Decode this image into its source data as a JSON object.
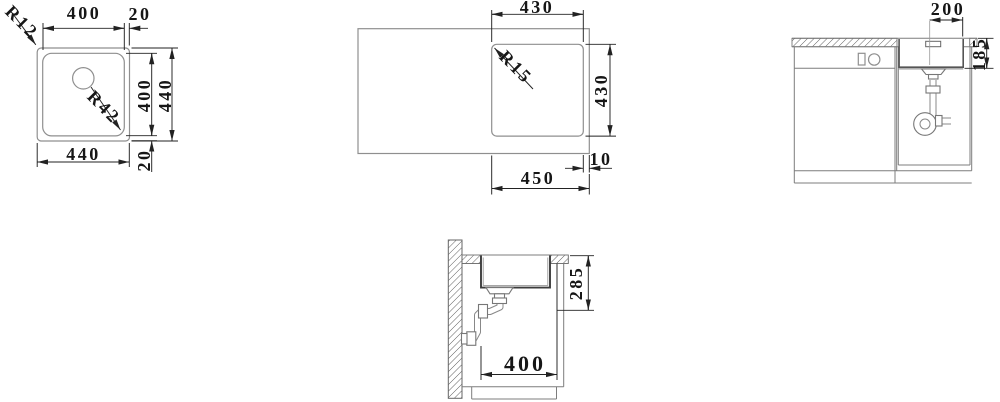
{
  "drawing_title": "sink-installation-drawing",
  "views": {
    "sink_top": {
      "dims": {
        "top_width": "400",
        "top_rim": "20",
        "inner_height": "400",
        "outer_height": "440",
        "bottom_width": "440",
        "bottom_rim": "20",
        "outer_corner_radius": "R12",
        "bowl_corner_radius": "R42"
      }
    },
    "cutout_plan": {
      "dims": {
        "cutout_width": "430",
        "cutout_height": "430",
        "edge_offset": "10",
        "overall": "450",
        "cutout_corner_radius": "R15"
      }
    },
    "cabinet_front": {
      "dims": {
        "drain_to_edge": "200",
        "bowl_depth": "185"
      }
    },
    "section_side": {
      "dims": {
        "outlet_height": "285",
        "bowl_width": "400"
      }
    }
  }
}
